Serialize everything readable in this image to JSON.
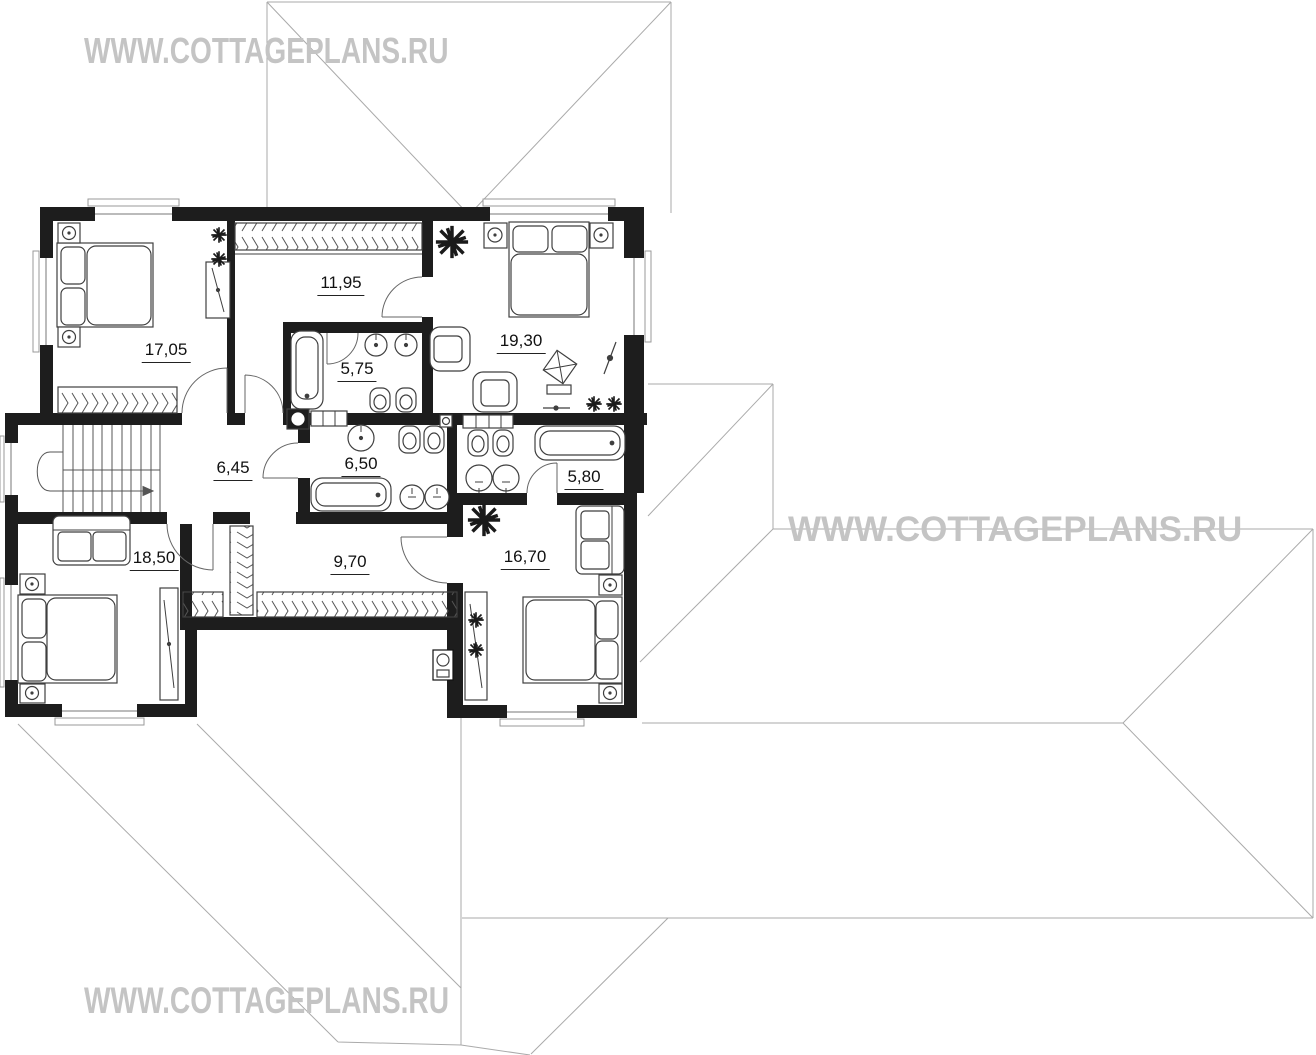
{
  "watermarks": [
    {
      "id": "top-left",
      "text": "WWW.COTTAGEPLANS.RU"
    },
    {
      "id": "middle-right",
      "text": "WWW.COTTAGEPLANS.RU"
    },
    {
      "id": "bottom-left",
      "text": "WWW.COTTAGEPLANS.RU"
    }
  ],
  "watermark_color": "#c4c4c4",
  "plan": {
    "wall_color": "#1d1d1d",
    "roof_line_color": "#aaaaaa",
    "furniture_line_color": "#3f3f3f"
  },
  "rooms": [
    {
      "id": "bedroom-top-left",
      "area": "17,05"
    },
    {
      "id": "dressing-room",
      "area": "11,95"
    },
    {
      "id": "bedroom-top-right",
      "area": "19,30"
    },
    {
      "id": "bathroom-middle",
      "area": "5,75"
    },
    {
      "id": "stair-hall",
      "area": "6,45"
    },
    {
      "id": "bathroom-center",
      "area": "6,50"
    },
    {
      "id": "bathroom-right",
      "area": "5,80"
    },
    {
      "id": "bedroom-bottom-left",
      "area": "18,50"
    },
    {
      "id": "hall-corridor",
      "area": "9,70"
    },
    {
      "id": "bedroom-bottom-right",
      "area": "16,70"
    }
  ]
}
